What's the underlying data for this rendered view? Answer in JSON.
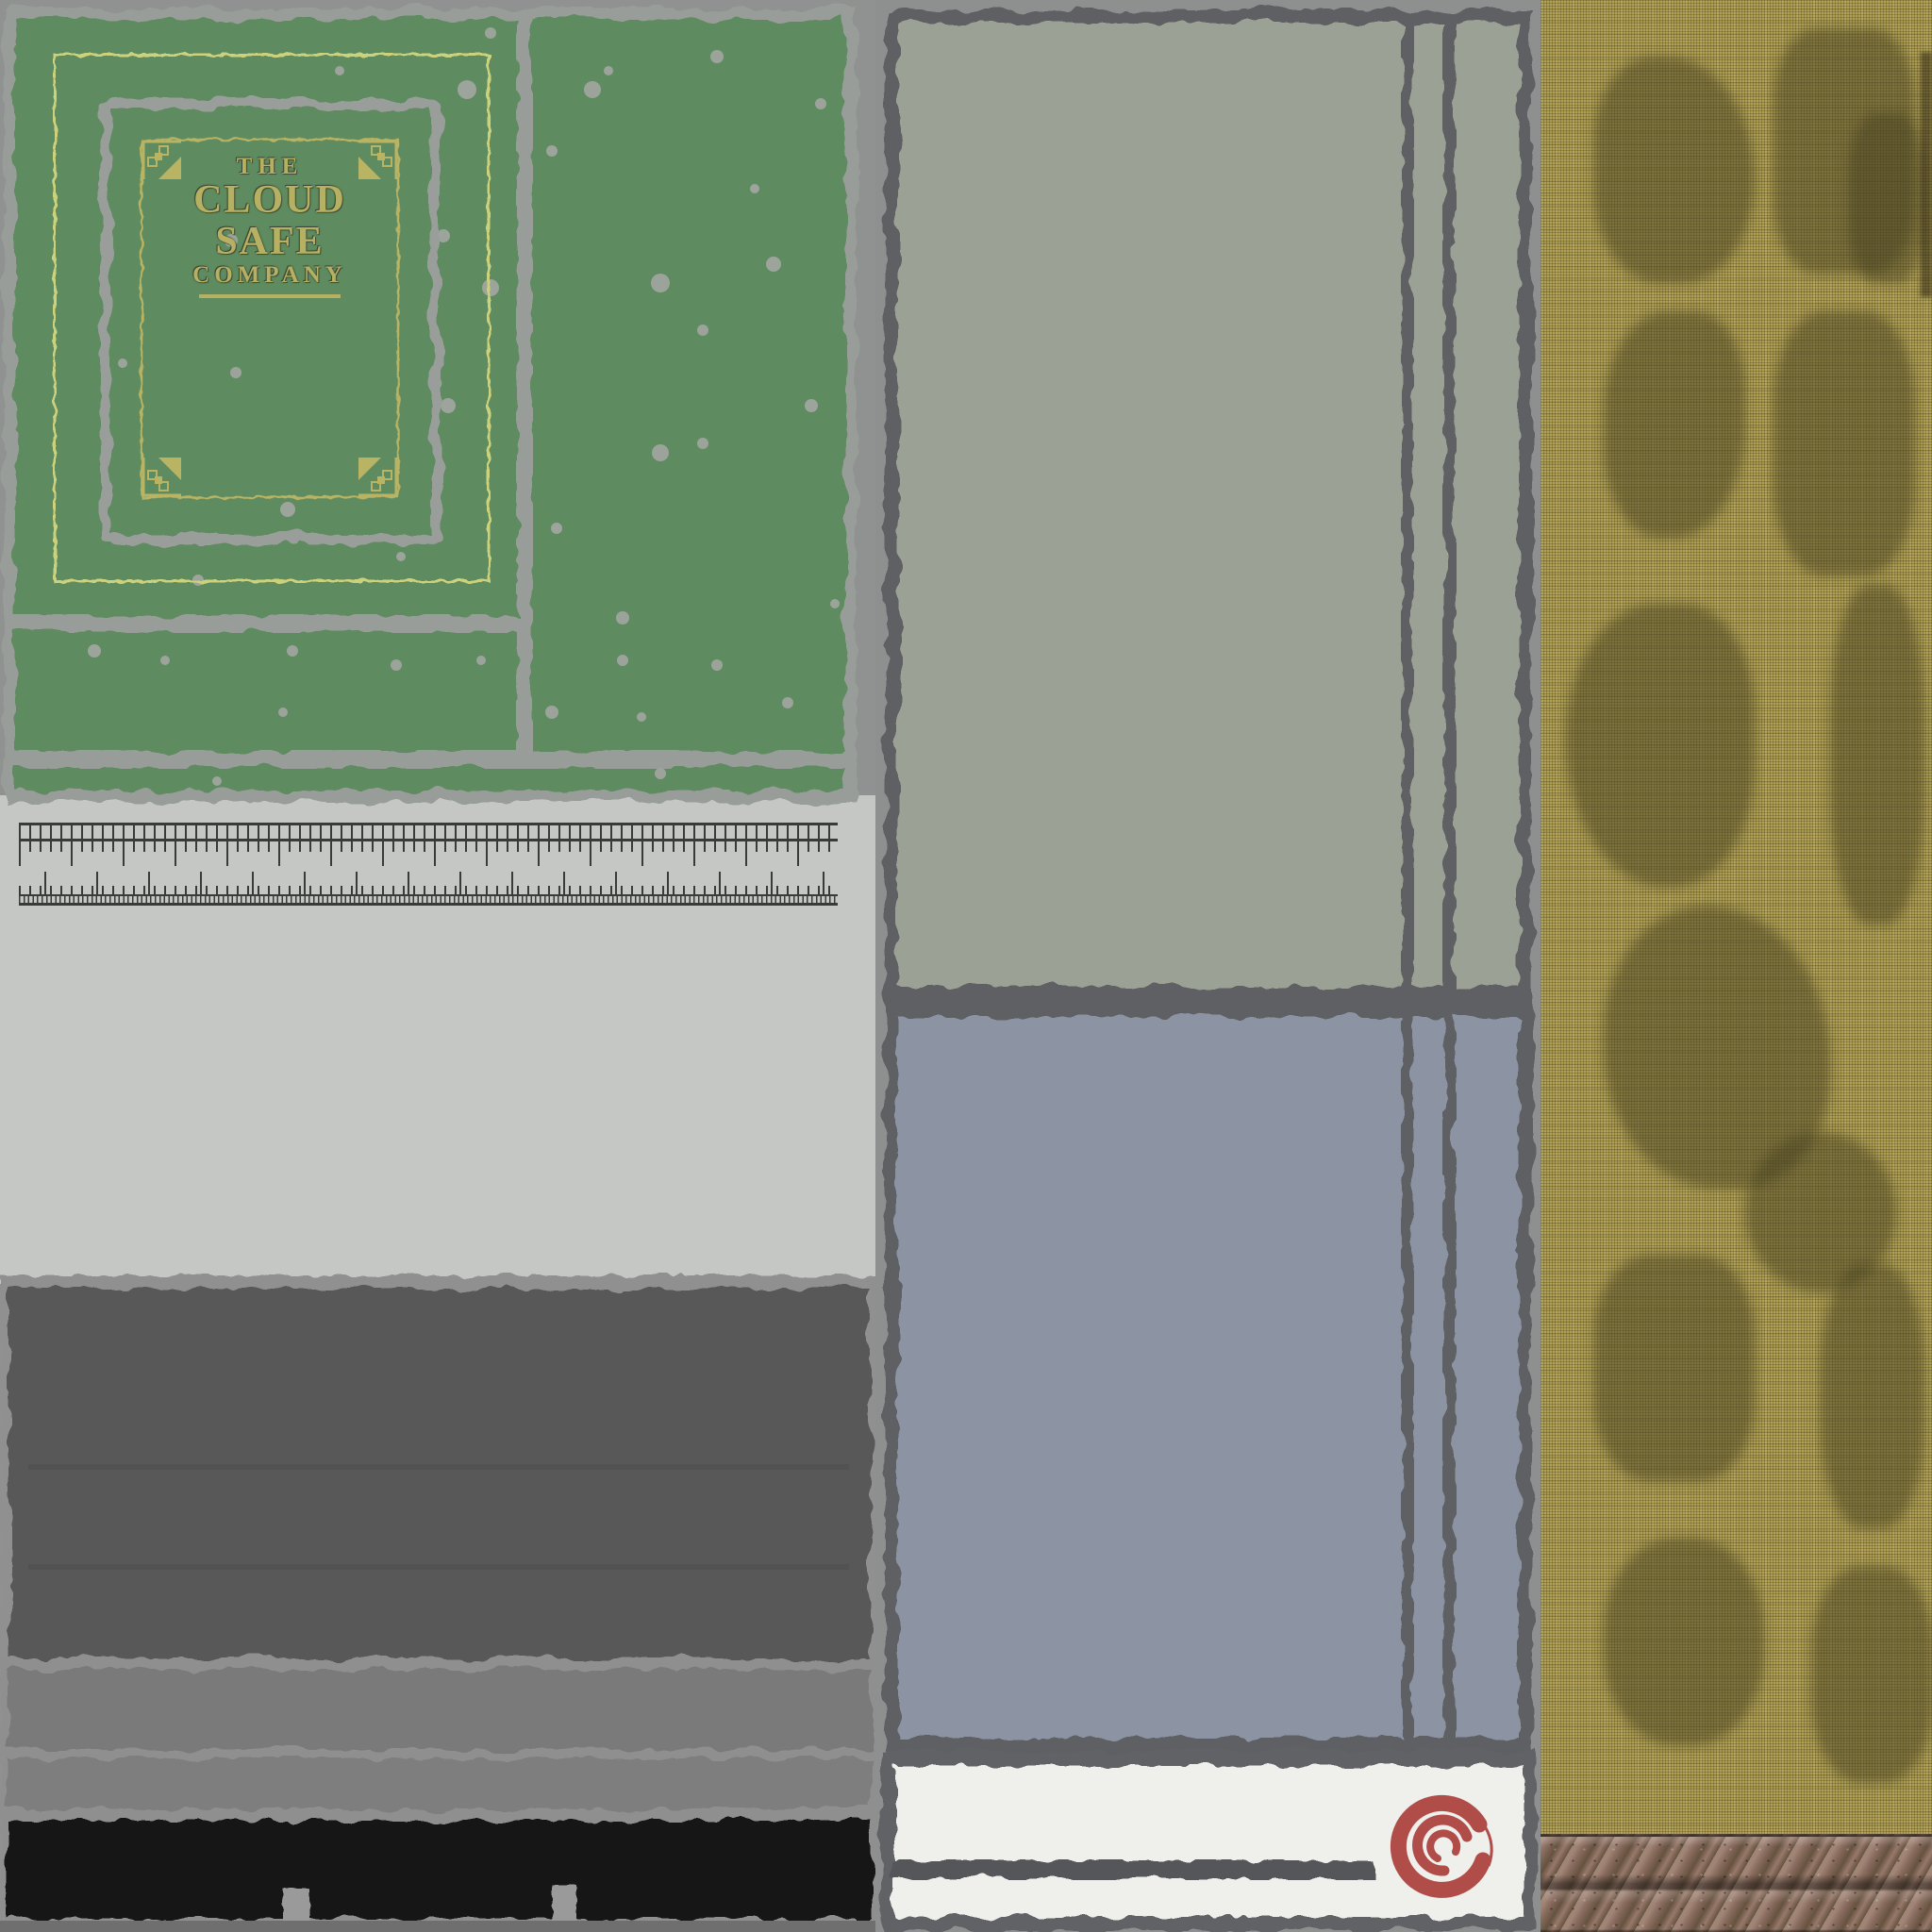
{
  "meta": {
    "kind": "texture-atlas",
    "subject": "weathered ledger safe-box texture sheet"
  },
  "book_cover": {
    "title_line1": "THE",
    "title_line2": "CLOUD SAFE",
    "title_line3": "COMPANY",
    "cover_green": "#5e8b61",
    "gold_text": "#b5b062",
    "pale_border": "#ccd17c",
    "worn_gray": "#999d99"
  },
  "palette": {
    "background_gray": "#8f9291",
    "page_gray": "#c5c7c4",
    "ruler_tick": "#3a3a3a",
    "dark_band": "#585858",
    "mid_band": "#7a7a7a",
    "black_band": "#171717",
    "sage_panel": "#9ba295",
    "slate_panel": "#8c93a3",
    "label_white": "#efefec",
    "torn_edge": "#5e6064",
    "logo_red": "#b04d49",
    "fabric_khaki": "#b1a156",
    "fabric_stain": "#484221",
    "rope_brown": "#7c6156"
  },
  "regions": {
    "front_cover": "green book front cover with gold frame",
    "page_edge": "page block with measuring rulers",
    "spine_bands": "gray and black torn spine strips",
    "paper_panels": "sage and slate paper panels",
    "label": "white label with red swirl logo",
    "fabric": "khaki burlap cloth with stains",
    "rope": "twisted brown rope"
  }
}
